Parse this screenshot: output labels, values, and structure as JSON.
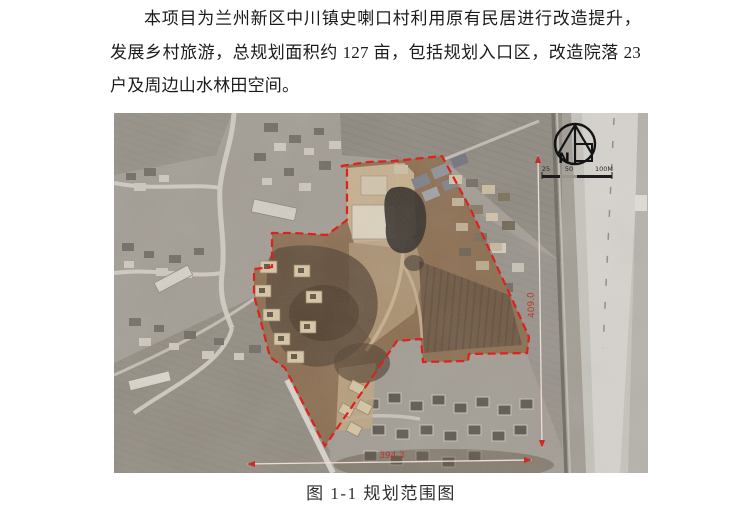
{
  "paragraph": {
    "lines": [
      "本项目为兰州新区中川镇史喇口村利用原有民居进行改造提升，",
      "发展乡村旅游，总规划面积约 127 亩，包括规划入口区，改造院落 23",
      "户及周边山水林田空间。"
    ]
  },
  "figure": {
    "caption": "图 1-1 规划范围图",
    "north_label": "N",
    "scale_ticks": [
      "25",
      "50",
      "100M"
    ],
    "dimensions": {
      "vertical": "409.0",
      "horizontal": "394.3"
    },
    "boundary_color": "#e0201a",
    "dimension_text_color": "#c23028"
  }
}
